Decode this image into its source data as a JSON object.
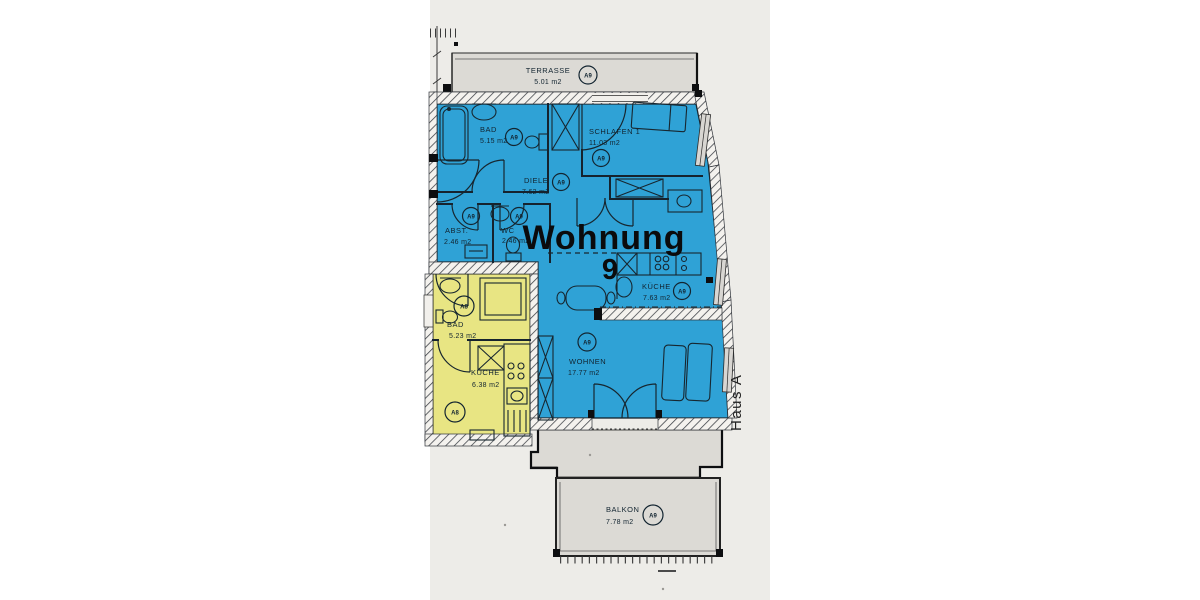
{
  "plan": {
    "title": {
      "label": "Wohnung",
      "number": "9"
    },
    "building_label": "Haus A",
    "colors": {
      "a9": "#2fa2d6",
      "a8": "#e8e583",
      "outdoor": "#dcdad5",
      "paper": "#edece8",
      "line": "#1a2430"
    },
    "rooms": [
      {
        "id": "terrasse",
        "name": "TERRASSE",
        "area": "5.01 m2",
        "unit": "A9"
      },
      {
        "id": "bad-a9",
        "name": "BAD",
        "area": "5.15 m2",
        "unit": "A9"
      },
      {
        "id": "schlafen",
        "name": "SCHLAFEN 1",
        "area": "11.03 m2",
        "unit": "A9"
      },
      {
        "id": "diele",
        "name": "DIELE",
        "area": "7.62 m2",
        "unit": "A9"
      },
      {
        "id": "abst",
        "name": "ABST.",
        "area": "2.46 m2",
        "unit": "A9"
      },
      {
        "id": "wc",
        "name": "WC",
        "area": "2.46 m2",
        "unit": "A9"
      },
      {
        "id": "kueche-a9",
        "name": "KÜCHE",
        "area": "7.63 m2",
        "unit": "A9"
      },
      {
        "id": "wohnen",
        "name": "WOHNEN",
        "area": "17.77 m2",
        "unit": "A9"
      },
      {
        "id": "balkon",
        "name": "BALKON",
        "area": "7.78 m2",
        "unit": "A9"
      },
      {
        "id": "bad-a8",
        "name": "BAD",
        "area": "5.23 m2",
        "unit": "A8"
      },
      {
        "id": "kueche-a8",
        "name": "KÜCHE",
        "area": "6.38 m2",
        "unit": "A8"
      }
    ]
  }
}
